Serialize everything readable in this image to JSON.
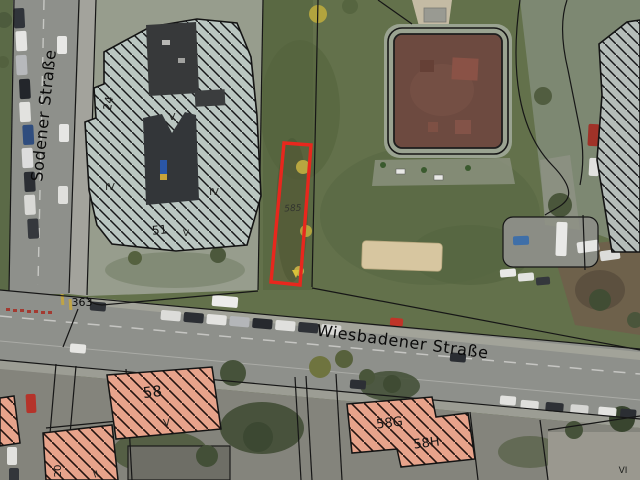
{
  "map": {
    "streets": {
      "sodener": {
        "label": "Sodener Straße"
      },
      "wiesbadener": {
        "label": "Wiesbadener Straße"
      }
    },
    "parcels": {
      "p363": {
        "label": "363"
      },
      "selected": {
        "label": "585",
        "outline_color": "#e8271d"
      }
    },
    "houses": {
      "h24": {
        "label": "24"
      },
      "h51": {
        "label": "51"
      },
      "h58": {
        "label": "58"
      },
      "h58g": {
        "label": "58G"
      },
      "h58h": {
        "label": "58H"
      },
      "h20": {
        "label": "20"
      }
    },
    "storeys": {
      "v_top": {
        "label": "V"
      },
      "iv_left": {
        "label": "IV"
      },
      "iv_right": {
        "label": "IV"
      },
      "v_mid": {
        "label": "V"
      },
      "v_58": {
        "label": "V"
      },
      "ii_bottom": {
        "label": "II"
      },
      "vi_right": {
        "label": "VI"
      }
    }
  }
}
